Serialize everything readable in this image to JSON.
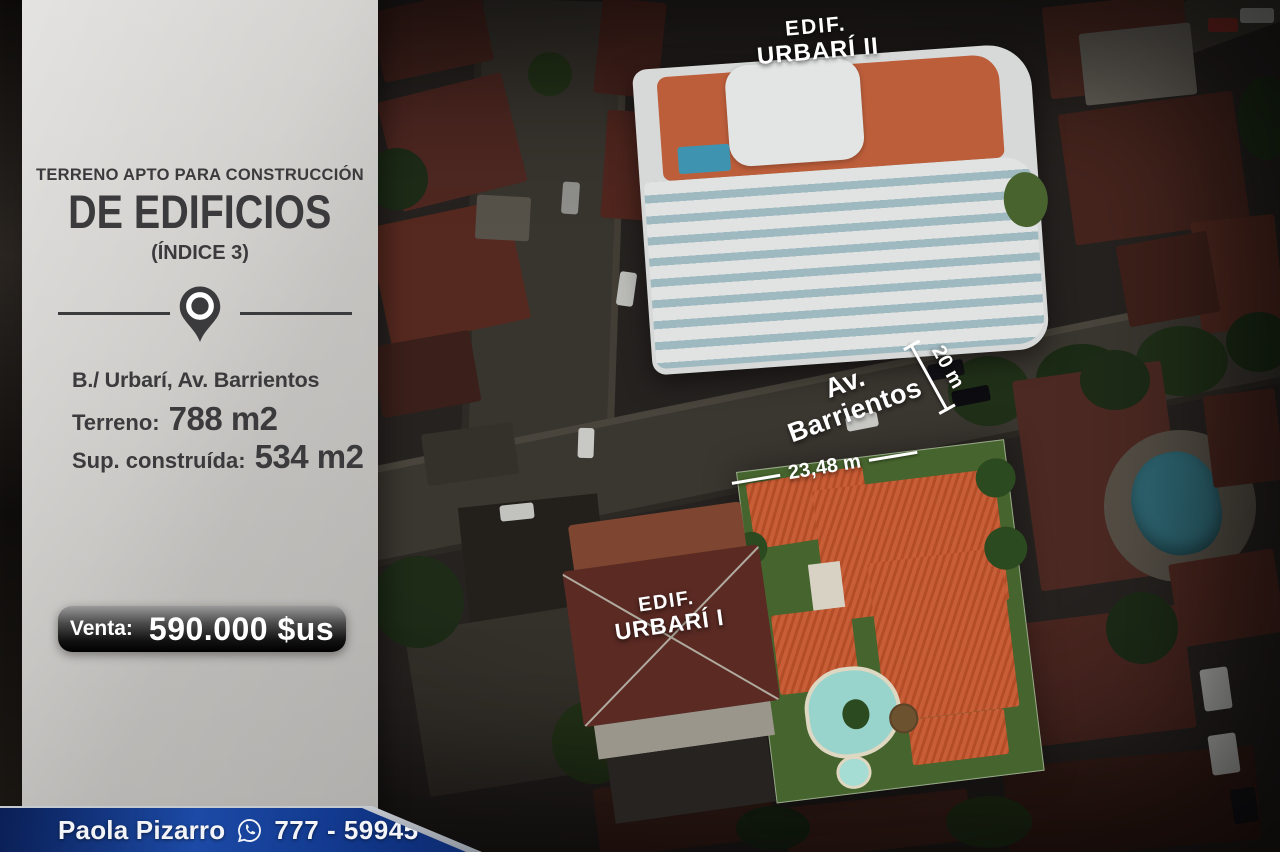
{
  "flyer": {
    "headline": {
      "line1": "TERRENO APTO PARA CONSTRUCCIÓN",
      "line2": "DE EDIFICIOS",
      "line3": "(ÍNDICE 3)"
    },
    "details": {
      "location": "B./ Urbarí, Av. Barrientos",
      "land_label": "Terreno:",
      "land_value": "788 m2",
      "built_label": "Sup. construída:",
      "built_value": "534 m2"
    },
    "price": {
      "label": "Venta:",
      "value": "590.000 $us"
    },
    "contact": {
      "name": "Paola Pizarro",
      "phone": "777 - 59945"
    }
  },
  "map_overlay": {
    "building_top": {
      "line1": "EDIF.",
      "line2": "URBARÍ II"
    },
    "building_bottom": {
      "line1": "EDIF.",
      "line2": "URBARÍ I"
    },
    "street": "Av. Barrientos",
    "street_width": "20 m",
    "lot_frontage": "23,48 m"
  },
  "icons": {
    "location_pin": "location-pin-icon",
    "whatsapp": "whatsapp-icon"
  },
  "colors": {
    "banner_blue": "#1c4aa6",
    "badge_dark": "#0a0a0a",
    "panel_gray": "#cfcdca",
    "highlight_roof": "#c5552c",
    "text_dark": "#3b3b3d",
    "annotation_white": "#ffffff"
  }
}
